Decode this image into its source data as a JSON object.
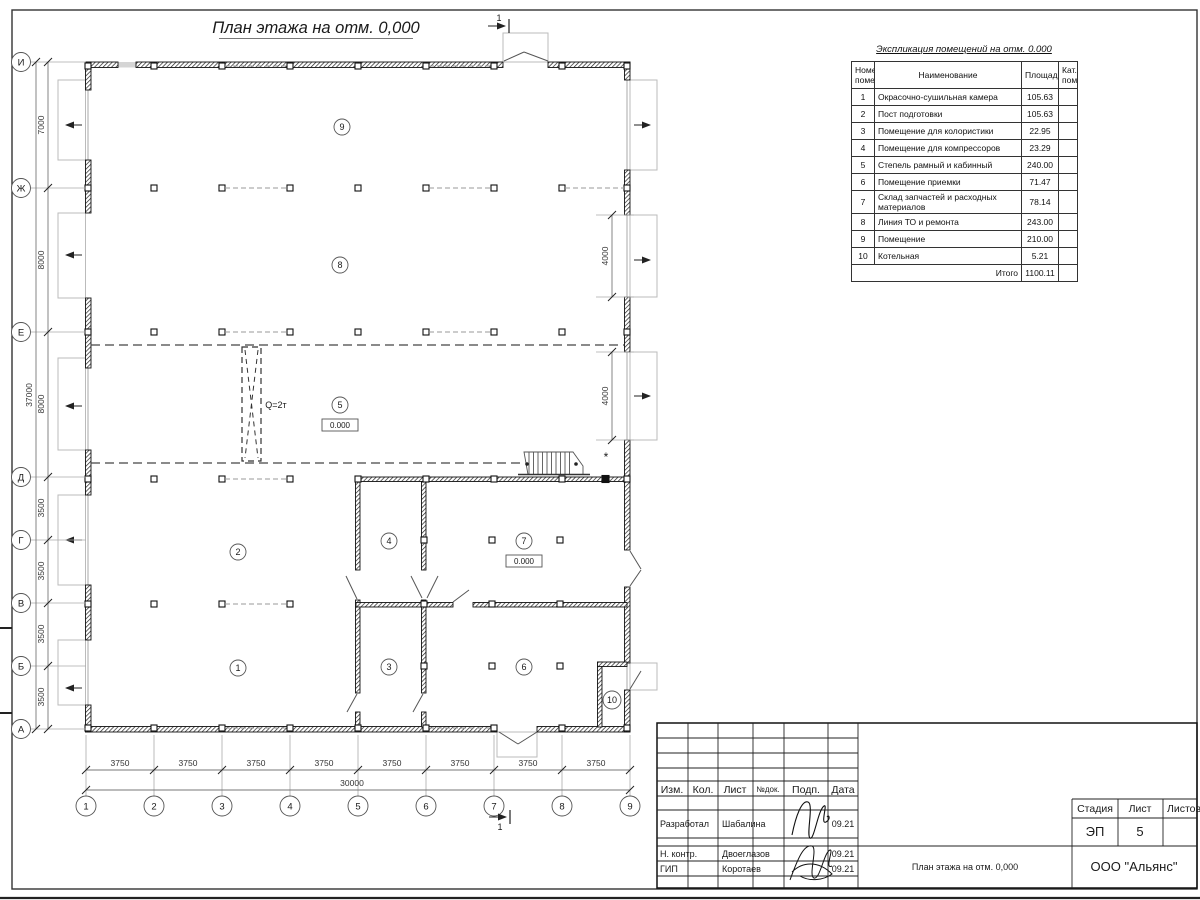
{
  "sheet": {
    "title": "План этажа на отм. 0,000"
  },
  "plan": {
    "row_axis_labels": [
      "И",
      "Ж",
      "Е",
      "Д",
      "Г",
      "В",
      "Б",
      "А"
    ],
    "col_axis_labels": [
      "1",
      "2",
      "3",
      "4",
      "5",
      "6",
      "7",
      "8",
      "9"
    ],
    "left_dims": [
      "7000",
      "8000",
      "8000",
      "3500",
      "3500",
      "3500",
      "3500"
    ],
    "left_total": "37000",
    "bottom_dims": [
      "3750",
      "3750",
      "3750",
      "3750",
      "3750",
      "3750",
      "3750",
      "3750"
    ],
    "bottom_total": "30000",
    "gate_dims": [
      "4000",
      "4000"
    ],
    "room_labels": [
      "1",
      "2",
      "3",
      "4",
      "5",
      "6",
      "7",
      "8",
      "9",
      "10"
    ],
    "level_marks": [
      "0.000",
      "0.000"
    ],
    "crane_label": "Q=2т",
    "section_label": "1",
    "asterisk": "*"
  },
  "schedule": {
    "title": "Экспликация помещений на отм. 0.000",
    "headers": {
      "num": "Номер помещ.",
      "name": "Наименование",
      "area": "Площадь",
      "cat": "Кат. пом."
    },
    "rows": [
      {
        "num": "1",
        "name": "Окрасочно-сушильная камера",
        "area": "105.63"
      },
      {
        "num": "2",
        "name": "Пост подготовки",
        "area": "105.63"
      },
      {
        "num": "3",
        "name": "Помещение для колористики",
        "area": "22.95"
      },
      {
        "num": "4",
        "name": "Помещение для компрессоров",
        "area": "23.29"
      },
      {
        "num": "5",
        "name": "Степель рамный и кабинный",
        "area": "240.00"
      },
      {
        "num": "6",
        "name": "Помещение приемки",
        "area": "71.47"
      },
      {
        "num": "7",
        "name": "Склад запчастей и расходных материалов",
        "area": "78.14"
      },
      {
        "num": "8",
        "name": "Линия ТО и ремонта",
        "area": "243.00"
      },
      {
        "num": "9",
        "name": "Помещение",
        "area": "210.00"
      },
      {
        "num": "10",
        "name": "Котельная",
        "area": "5.21"
      }
    ],
    "total_label": "Итого",
    "total": "1100.11"
  },
  "titleblock": {
    "header_cells": [
      "Изм.",
      "Кол.",
      "Лист",
      "№док.",
      "Подп.",
      "Дата"
    ],
    "rows": [
      {
        "role": "Разработал",
        "name": "Шабалина",
        "date": "09.21"
      },
      {
        "role": "Н. контр.",
        "name": "Двоеглазов",
        "date": "09.21"
      },
      {
        "role": "ГИП",
        "name": "Коротаев",
        "date": "09.21"
      }
    ],
    "stage_label": "Стадия",
    "sheet_label": "Лист",
    "sheets_label": "Листов",
    "stage": "ЭП",
    "sheet_num": "5",
    "doc_title": "План этажа на отм. 0,000",
    "company": "ООО \"Альянс\""
  }
}
